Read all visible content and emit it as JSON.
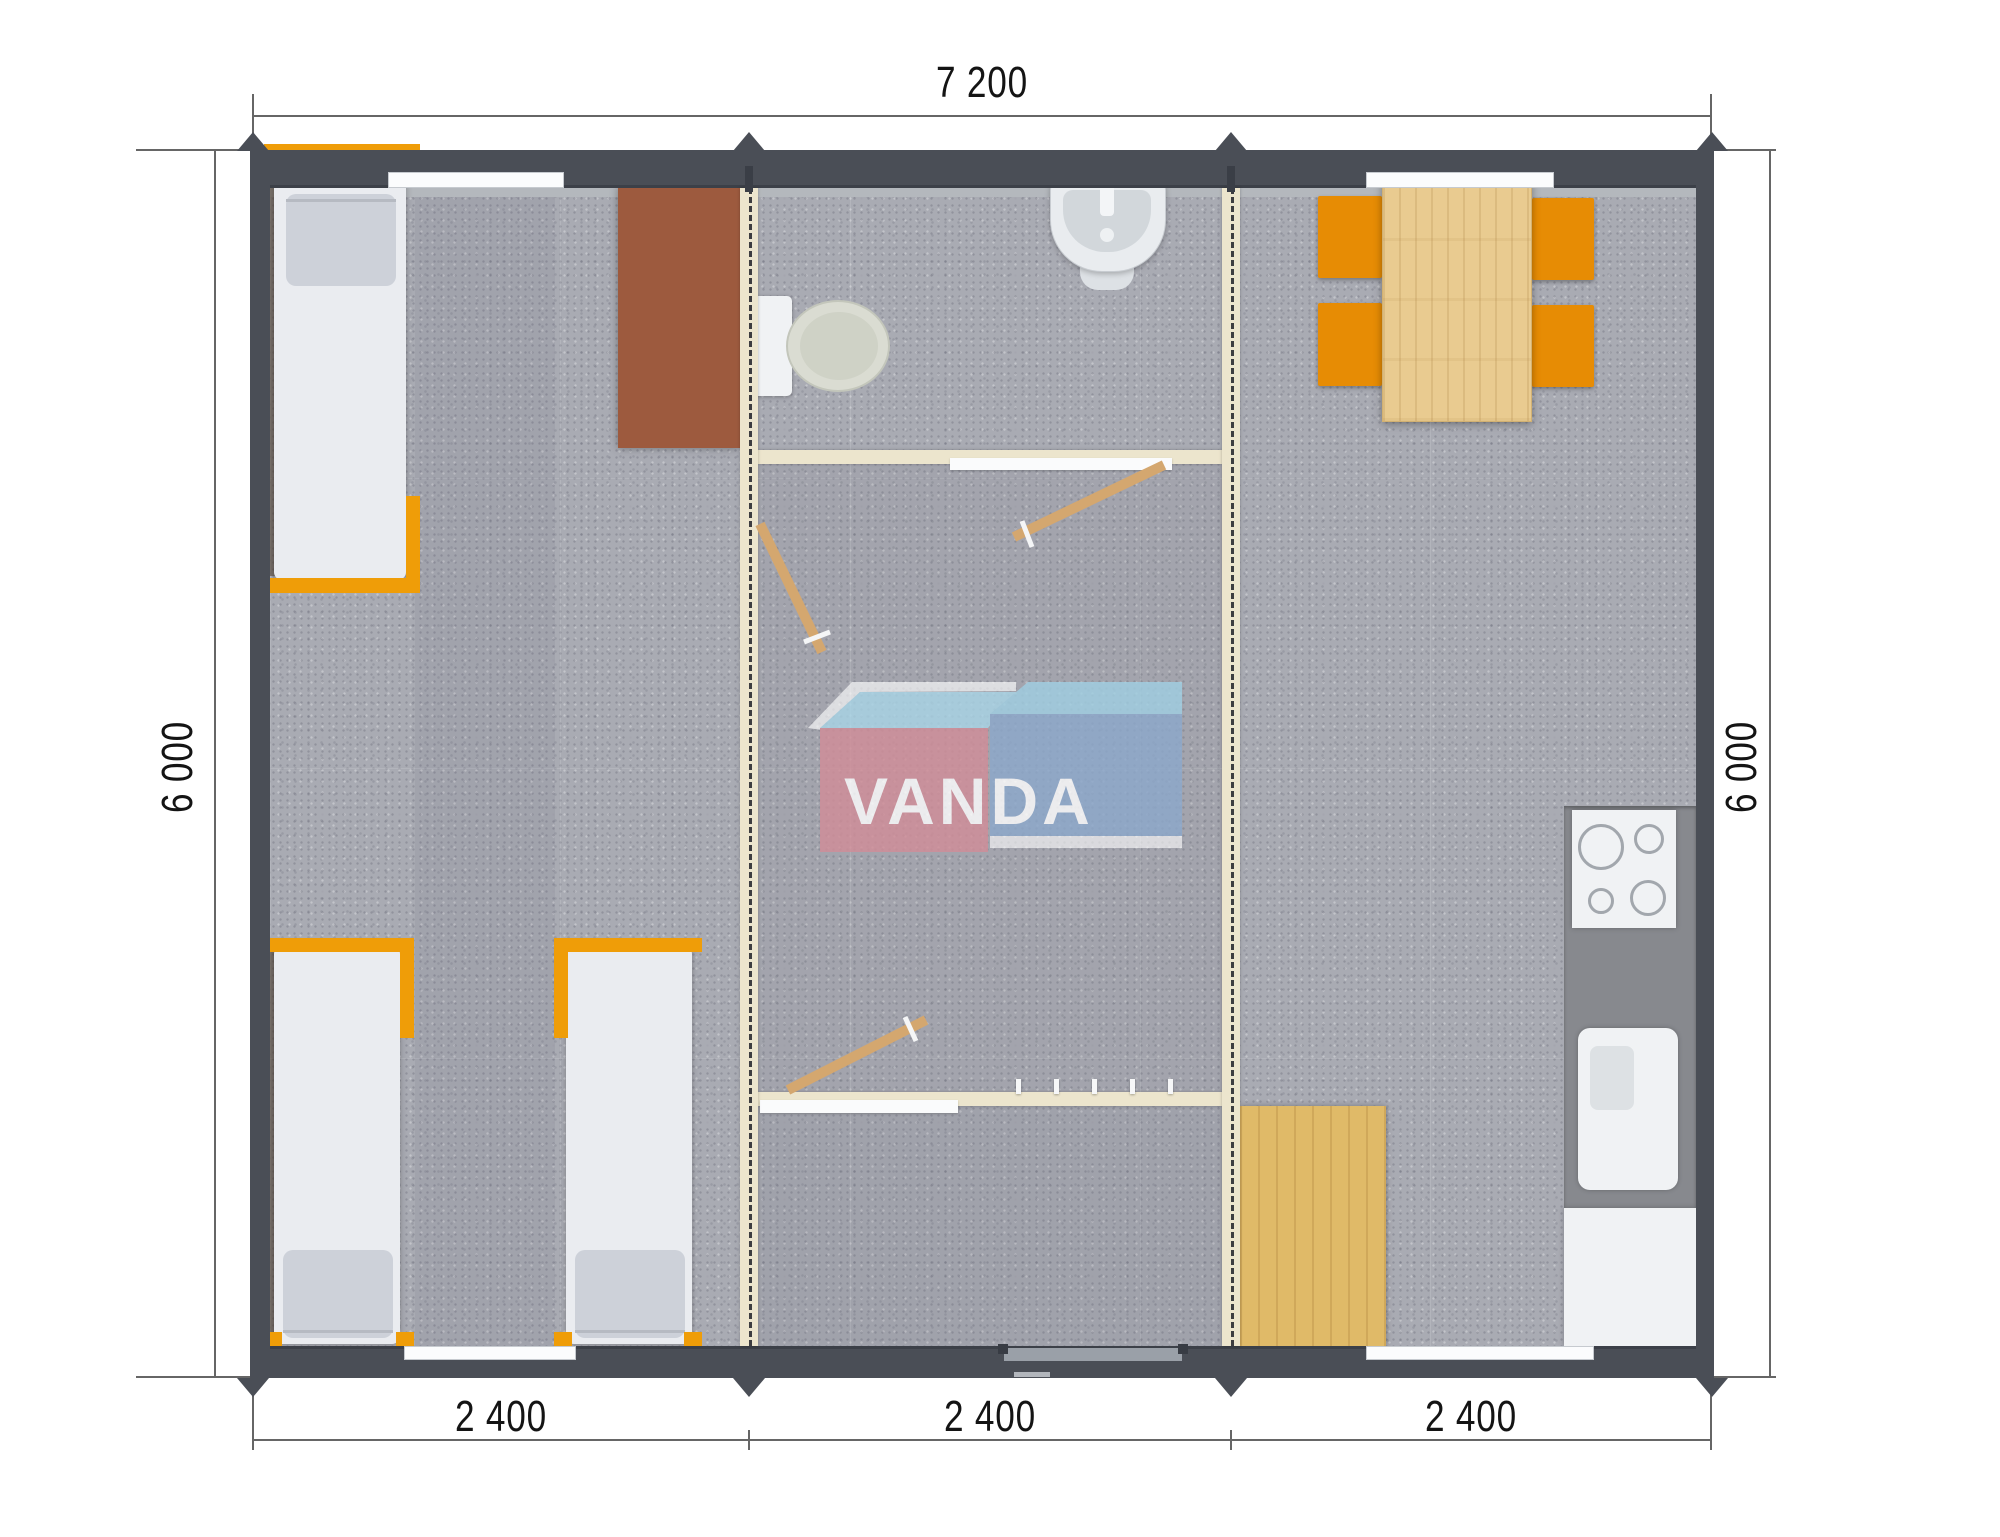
{
  "dimensions": {
    "overall_width_label": "7 200",
    "overall_depth_left_label": "6 000",
    "overall_depth_right_label": "6 000",
    "module_width_labels": [
      "2 400",
      "2 400",
      "2 400"
    ]
  },
  "logo": {
    "text": "VANDA"
  },
  "colors": {
    "outer_wall": "#4a4e56",
    "partition_wall": "#ece5cd",
    "floor": "#a9abb3",
    "bed_frame_orange": "#ef9d08",
    "chair_orange": "#e78c04",
    "table_wood": "#e9cb90",
    "mat_wood": "#e0ba68",
    "desk_brown": "#9d5a3e",
    "kitchen_counter": "#87898e",
    "logo_pink": "#d28d98",
    "logo_blue": "#8ca8cb",
    "logo_sky": "#a9d5e7"
  }
}
